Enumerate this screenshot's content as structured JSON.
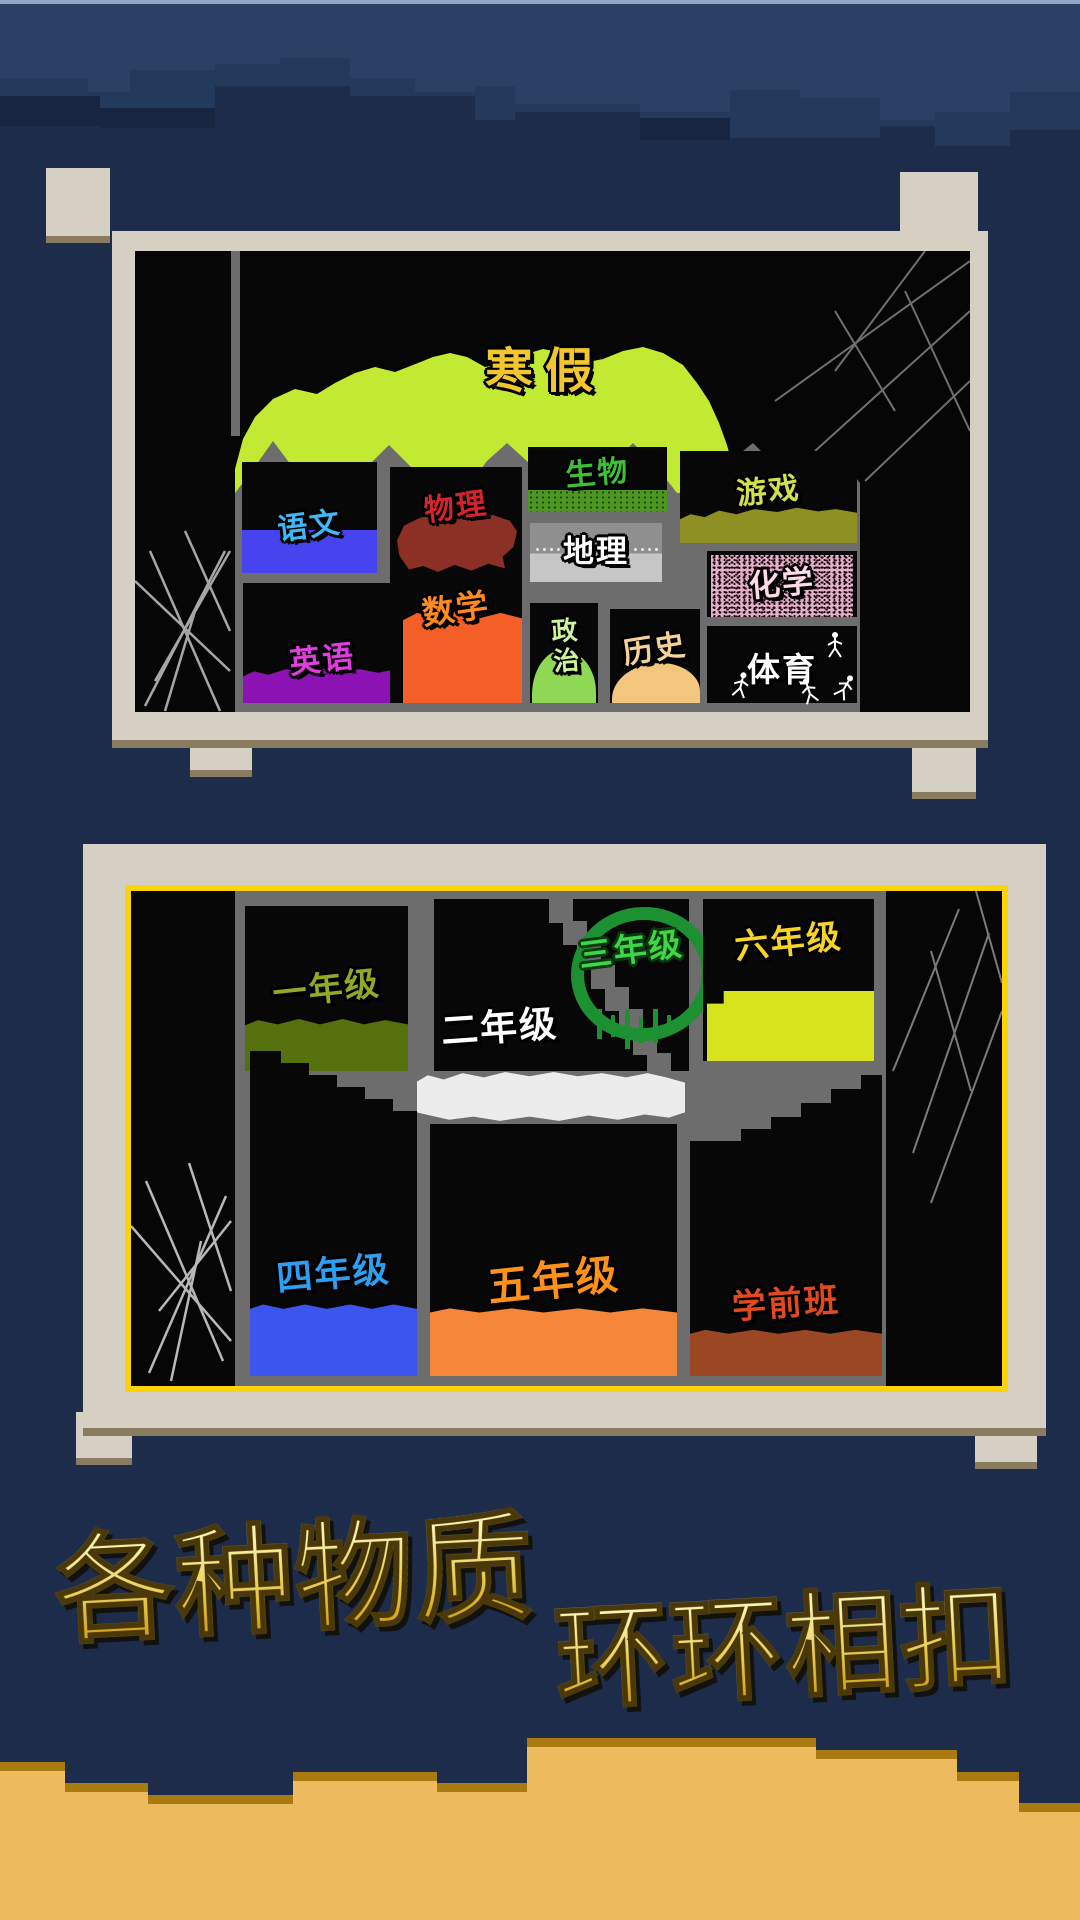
{
  "background": {
    "sky_base_color": "#1e2c4c",
    "sky_band_light_color": "#2b4065",
    "sky_band_mid_color": "#233a5c",
    "sand_color": "#eeba5e",
    "sand_edge_color": "#a87a10"
  },
  "frame": {
    "color": "#d6d0c4",
    "shadow_color": "#8a7c60",
    "panel2_border_color": "#fcd306",
    "wall_color": "#6d6d6d"
  },
  "panel1": {
    "name": "subjects-cave-map",
    "title": {
      "label": "寒假",
      "color": "#f2c72e"
    },
    "terrain_color": "#c3ea33",
    "rooms": [
      {
        "label": "语文",
        "text_color": "#3fb8f8",
        "block_color": "#4743ef"
      },
      {
        "label": "物理",
        "text_color": "#d6242c",
        "block_color": "#8c3026"
      },
      {
        "label": "数学",
        "text_color": "#ff8a1f",
        "block_color": "#f45f28"
      },
      {
        "label": "英语",
        "text_color": "#e03ce0",
        "block_color": "#8c12b4"
      },
      {
        "label": "生物",
        "text_color": "#3fbf37",
        "block_color": "#4c9622"
      },
      {
        "label": "地理",
        "text_color": "#ffffff",
        "block_color": "#c6c6c6"
      },
      {
        "label": "政治",
        "text_color": "#cdf49b",
        "block_color": "#8fd855"
      },
      {
        "label": "历史",
        "text_color": "#f6d395",
        "block_color": "#f3c67d"
      },
      {
        "label": "游戏",
        "text_color": "#d0e14e",
        "block_color": "#8e9023"
      },
      {
        "label": "化学",
        "text_color": "#ffd9e6",
        "block_color": "#e2afc6"
      },
      {
        "label": "体育",
        "text_color": "#ffffff",
        "block_color": "#000000"
      }
    ]
  },
  "panel2": {
    "name": "grades-cave-map",
    "platform_color": "#ececec",
    "rooms": [
      {
        "label": "一年级",
        "text_color": "#93a823",
        "block_color": "#57700e"
      },
      {
        "label": "二年级",
        "text_color": "#ffffff",
        "block_color": "#ececec"
      },
      {
        "label": "三年级",
        "text_color": "#3fd547",
        "block_color": "#1d9032"
      },
      {
        "label": "六年级",
        "text_color": "#f6d428",
        "block_color": "#d7e31c"
      },
      {
        "label": "四年级",
        "text_color": "#2d9ff2",
        "block_color": "#3c55ee"
      },
      {
        "label": "五年级",
        "text_color": "#ff9019",
        "block_color": "#f5863a"
      },
      {
        "label": "学前班",
        "text_color": "#e2491d",
        "block_color": "#9c4724"
      }
    ]
  },
  "tagline": {
    "line1": "各种物质",
    "line2": "环环相扣",
    "color_top": "#faf3b0",
    "color_bottom": "#cf9d14"
  }
}
